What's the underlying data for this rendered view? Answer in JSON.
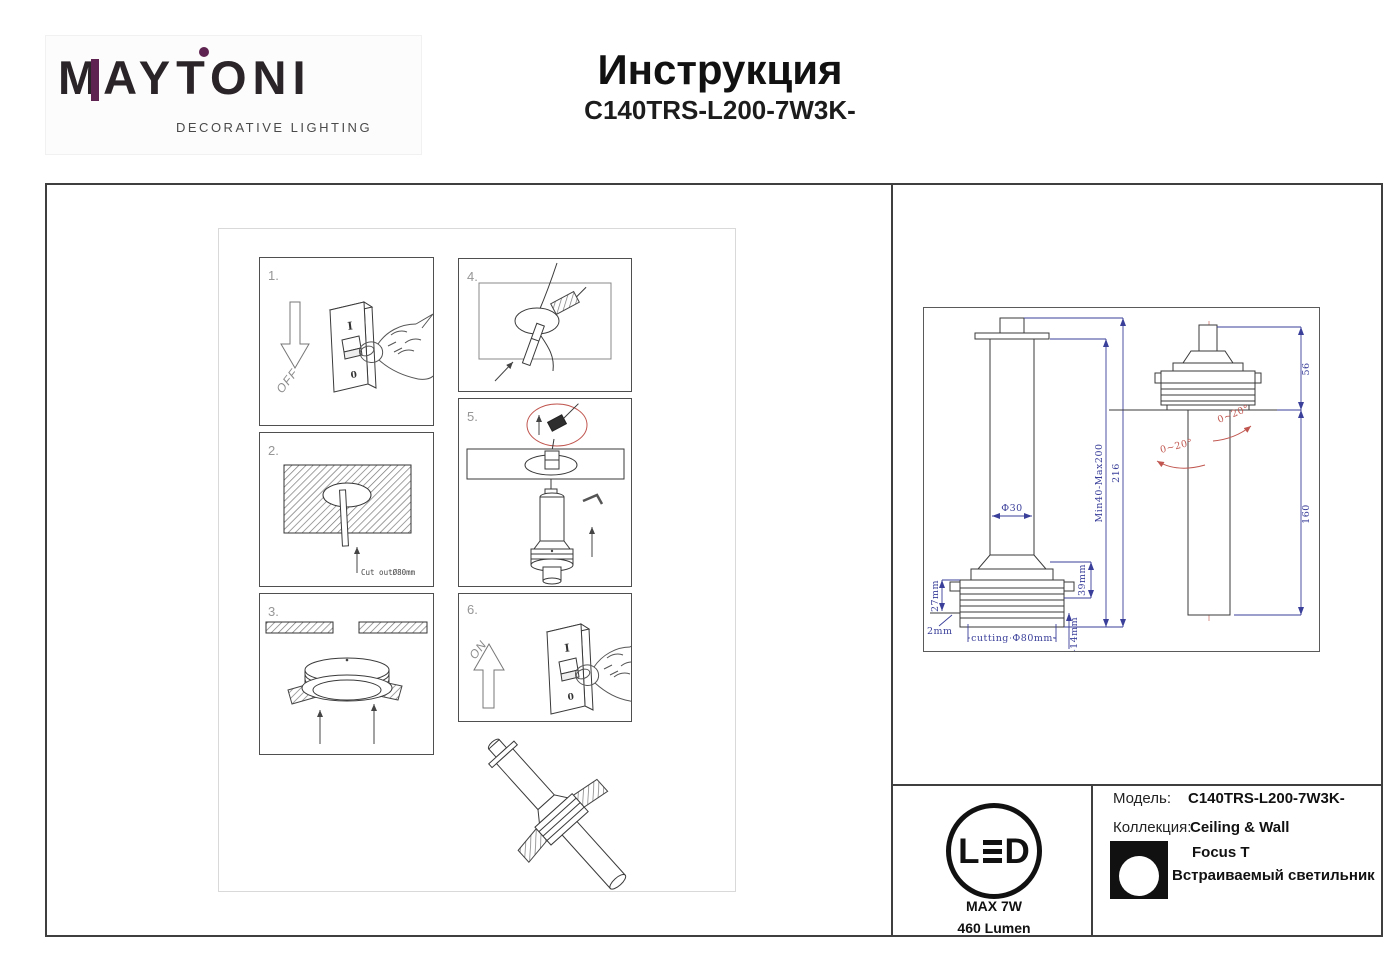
{
  "logo": {
    "m": "M",
    "rest": "AYTONI",
    "tagline": "DECORATIVE LIGHTING",
    "accent_color": "#5E2350"
  },
  "header": {
    "title": "Инструкция",
    "model": "C140TRS-L200-7W3K-"
  },
  "steps": {
    "n1": "1.",
    "n2": "2.",
    "n3": "3.",
    "n4": "4.",
    "n5": "5.",
    "n6": "6.",
    "off_label": "OFF",
    "on_label": "ON",
    "switch_i": "I",
    "switch_o": "0",
    "cut_label": "Cut outØ80mm"
  },
  "drawing": {
    "dia30": "Ф30",
    "min_max": "Min40-Max200",
    "h216": "216",
    "d27": "27mm",
    "d2": "2mm",
    "cutting": "cutting Ф80mm",
    "d39": "39mm",
    "d2_14": "2-14mm",
    "a56": "56",
    "a160": "160",
    "angle": "0~20°",
    "dim_color": "#3A3F99",
    "red_color": "#C0564F"
  },
  "info": {
    "led_l": "L",
    "led_d": "D",
    "max_power": "MAX 7W",
    "lumen": "460 Lumen",
    "model_label": "Модель:",
    "model_value": "C140TRS-L200-7W3K-",
    "collection_label": "Коллекция:",
    "collection_value": "Ceiling & Wall",
    "series": "Focus T",
    "type": "Встраиваемый светильник"
  }
}
